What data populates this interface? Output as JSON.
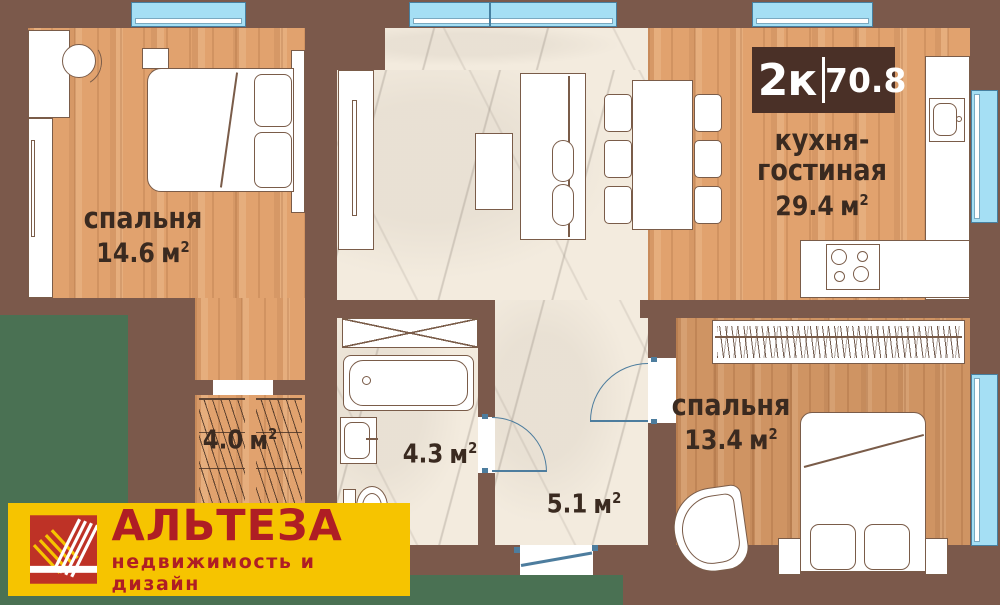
{
  "badge": {
    "left": "2к",
    "right": "70.8"
  },
  "rooms": {
    "bedroom1": {
      "name": "спальня",
      "area": "14.6",
      "unit": "м",
      "sup": "2"
    },
    "kitchen_living": {
      "name1": "кухня-",
      "name2": "гостиная",
      "area": "29.4",
      "unit": "м",
      "sup": "2"
    },
    "bedroom2": {
      "name": "спальня",
      "area": "13.4",
      "unit": "м",
      "sup": "2"
    },
    "closet": {
      "area": "4.0",
      "unit": "м",
      "sup": "2"
    },
    "bathroom": {
      "area": "4.3",
      "unit": "м",
      "sup": "2"
    },
    "hallway": {
      "area": "5.1",
      "unit": "м",
      "sup": "2"
    }
  },
  "logo": {
    "title": "АЛЬТЕЗА",
    "subtitle": "недвижимость и дизайн"
  },
  "colors": {
    "background_green": "#4A7153",
    "wall_brown": "#7B594B",
    "wood_light": "#E1A26E",
    "wood_dark": "#CF9463",
    "marble": "#F3EBDE",
    "window_blue": "#A5DFF4",
    "badge_brown": "#4A3027",
    "logo_yellow": "#F6C400",
    "logo_red": "#AF1E24",
    "door_blue": "#4d7d9e"
  }
}
